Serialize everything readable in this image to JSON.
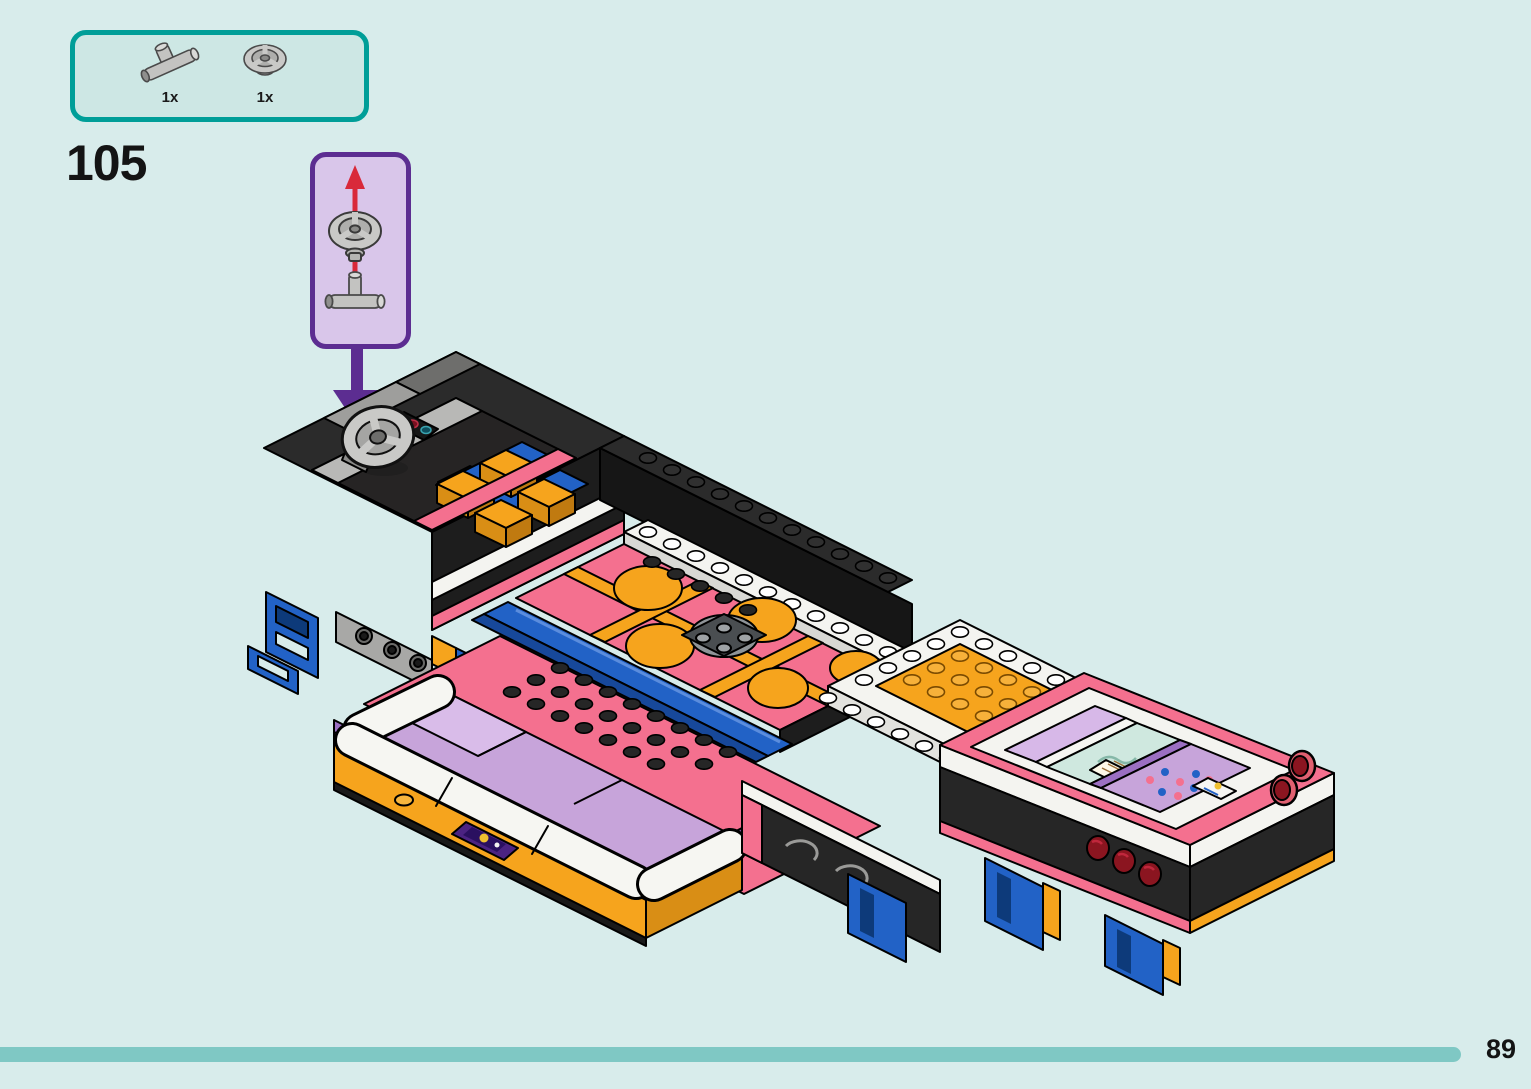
{
  "step": {
    "number": "105"
  },
  "parts_callout": {
    "parts": [
      {
        "count": "1x",
        "icon": "t-axle-connector-icon"
      },
      {
        "count": "1x",
        "icon": "steering-wheel-icon"
      }
    ]
  },
  "inset": {
    "icons": [
      "red-up-arrow-icon",
      "steering-wheel-icon",
      "t-axle-connector-icon"
    ],
    "connector_arrow_icon": "purple-down-arrow-icon"
  },
  "illustration": {
    "subject": "lego-friends-bus-chassis",
    "sections": [
      "driver-cab-with-steering-wheel",
      "pink-dance-floor-deck",
      "orange-studded-platform",
      "bed-assembly",
      "white-couch-assembly",
      "chassis-underside-with-taillights"
    ]
  },
  "page": {
    "number": "89"
  },
  "colors": {
    "background": "#d8eceb",
    "callout_border": "#009e98",
    "callout_bg": "#cde7e4",
    "inset_border": "#5c2d91",
    "inset_bg": "#d9c6ea",
    "red_arrow": "#d9293a",
    "purple_arrow": "#5c2d91",
    "progress_bar": "#7fc8c4",
    "brick_pink": "#f4708f",
    "brick_orange": "#f6a41d",
    "brick_blue": "#2262c6",
    "brick_black": "#2b2b2b",
    "brick_white": "#f4f4f0",
    "brick_lavender": "#c7a4da",
    "brick_purple": "#9b6fc2",
    "brick_gray": "#a9a9a7",
    "taillight_red": "#8b1520"
  }
}
